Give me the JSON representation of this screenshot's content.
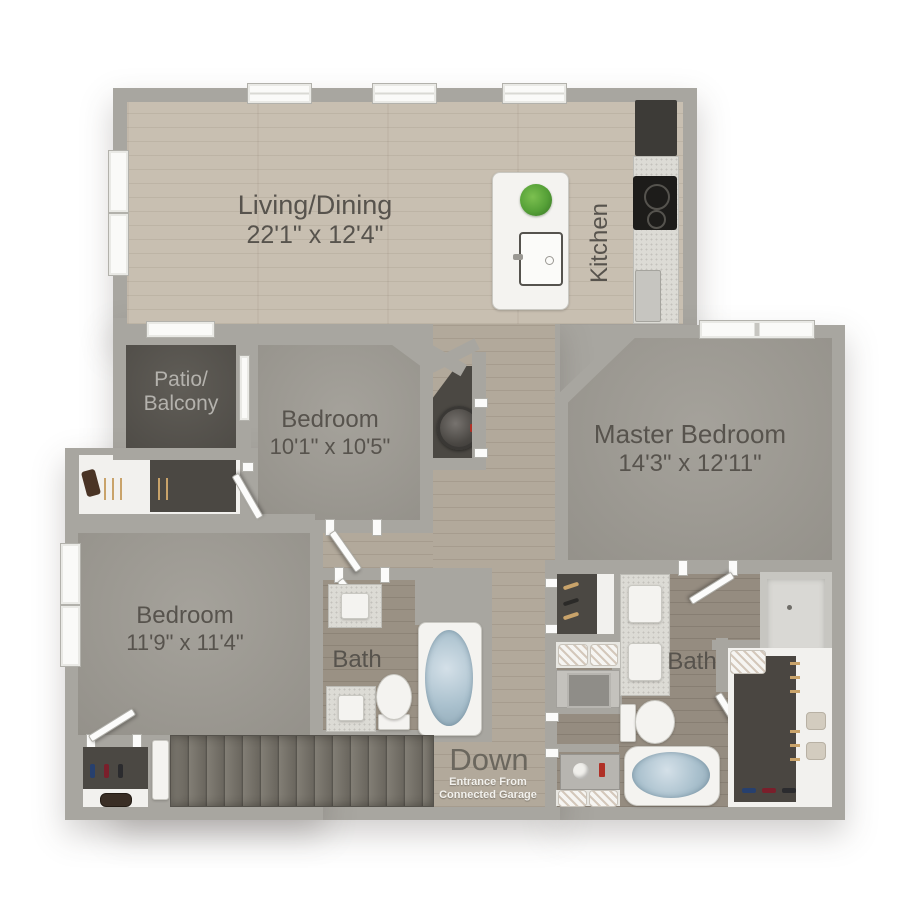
{
  "rooms": {
    "living_dining": {
      "name": "Living/Dining",
      "dims": "22'1\" x 12'4\""
    },
    "kitchen": {
      "name": "Kitchen"
    },
    "patio": {
      "line1": "Patio/",
      "line2": "Balcony"
    },
    "bedroom1": {
      "name": "Bedroom",
      "dims": "10'1\" x 10'5\""
    },
    "master_bedroom": {
      "name": "Master Bedroom",
      "dims": "14'3\" x 12'11\""
    },
    "bedroom2": {
      "name": "Bedroom",
      "dims": "11'9\" x 11'4\""
    },
    "bath1": {
      "name": "Bath"
    },
    "master_bath": {
      "name": "Bath"
    },
    "stairs": {
      "label": "Down",
      "note_line1": "Entrance From",
      "note_line2": "Connected Garage"
    }
  },
  "colors": {
    "wall": "#a8a6a0",
    "wood_light": "#c8bfb1",
    "wood_hall": "#b2a99b",
    "wood_bath_dark": "#958c80",
    "carpet": "#9d9a93",
    "patio_floor": "#565450",
    "closet_floor": "#4b4843",
    "stairs_floor": "#716d66",
    "tub_water": "#aec6d2",
    "fixture_white": "#f4f3f0",
    "label_text": "#57534d",
    "note_text": "#f2f1ed",
    "plant_green": "#55a037"
  }
}
